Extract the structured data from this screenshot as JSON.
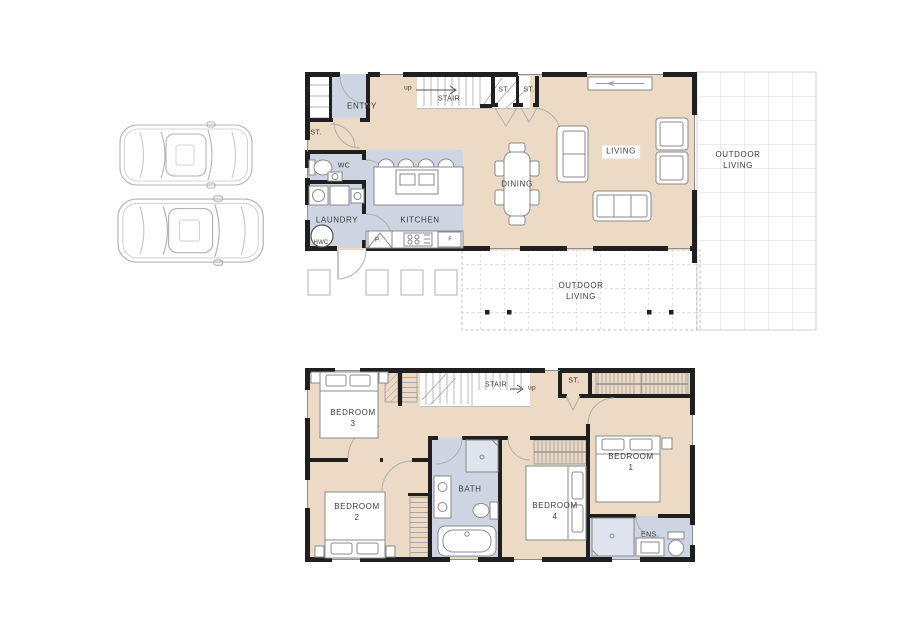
{
  "ground_floor": {
    "labels": {
      "entry": "ENTRY",
      "st_hall": "ST.",
      "wc": "WC",
      "laundry": "LAUNDRY",
      "hwc": "HWC",
      "kitchen": "KITCHEN",
      "pantry": "P.",
      "fridge": "F",
      "stair": "STAIR",
      "up": "up",
      "st1": "ST.",
      "st2": "ST.",
      "dining": "DINING",
      "living": "LIVING",
      "outdoor_right": "OUTDOOR\nLIVING",
      "outdoor_bottom": "OUTDOOR\nLIVING"
    }
  },
  "upper_floor": {
    "labels": {
      "bedroom3": "BEDROOM\n3",
      "stair": "STAIR",
      "up": "up",
      "st": "ST.",
      "bedroom1": "BEDROOM\n1",
      "bedroom2": "BEDROOM\n2",
      "bath": "BATH",
      "bedroom4": "BEDROOM\n4",
      "ensuite": "ENS."
    }
  },
  "colors": {
    "floor_fill": "#ecdac5",
    "wet_area_fill": "#cdd5e3",
    "wall": "#1f1f1f",
    "furniture_line": "#8a8a8a",
    "grid_line": "#dadada",
    "pergola_line": "#c2c2c2",
    "car_line": "#b3b3b3",
    "label_text": "#3a3a3a"
  }
}
